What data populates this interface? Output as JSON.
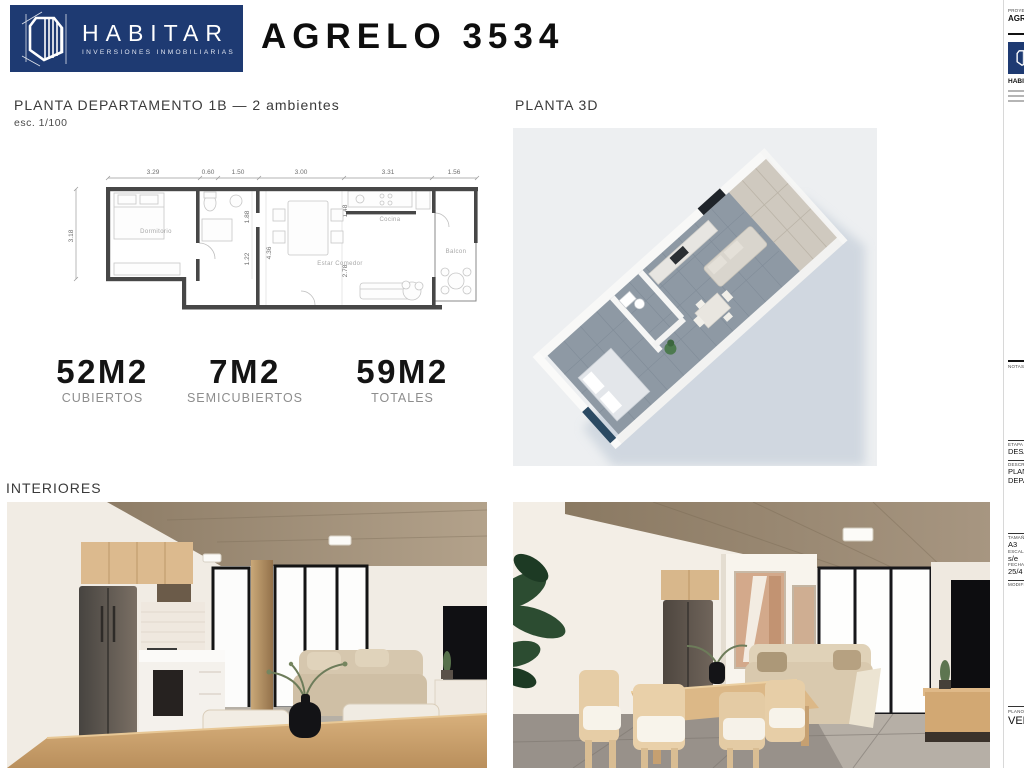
{
  "header": {
    "brand": {
      "name": "HABITAR",
      "subtitle": "INVERSIONES INMOBILIARIAS",
      "bg_color": "#1e3a72"
    },
    "sheet_title": "AGRELO 3534"
  },
  "plan_section": {
    "title": "PLANTA DEPARTAMENTO 1B — 2 ambientes",
    "scale_note": "esc. 1/100",
    "floor_plan": {
      "room_labels": [
        "Dormitorio",
        "Cocina",
        "Estar Comedor",
        "Balcon"
      ],
      "dims_top": [
        "3.29",
        "0.60",
        "1.50",
        "3.00",
        "3.31",
        "1.56"
      ],
      "dim_left": "3.18",
      "dims_inner": [
        "1.88",
        "1.22",
        "4.36",
        "2.78",
        "1.48"
      ]
    }
  },
  "areas": [
    {
      "value": "52M2",
      "label": "CUBIERTOS"
    },
    {
      "value": "7M2",
      "label": "SEMICUBIERTOS"
    },
    {
      "value": "59M2",
      "label": "TOTALES"
    }
  ],
  "planta3d_title": "PLANTA 3D",
  "interiores_title": "INTERIORES",
  "titleblock": {
    "project_label": "PROYECTO",
    "project_value": "AGRELO 3534",
    "brand": "HABITAR",
    "notes_label": "NOTAS",
    "stage_label": "ETAPA",
    "stage_value": "DESARROLLO",
    "description_label": "DESCRIPCIÓN",
    "description_value_line1": "PLANTA",
    "description_value_line2": "DEPARTAMENTO",
    "size_label": "TAMAÑO",
    "size_value": "A3",
    "scale_label": "ESCALA",
    "scale_value": "s/e",
    "date_label": "FECHA",
    "date_value": "25/4",
    "modifications_label": "MODIFICACIONES",
    "sheet_label": "PLANO N",
    "sheet_value": "VENTA"
  },
  "colors": {
    "brand_navy": "#1e3a72",
    "plan_wall": "#474747",
    "render_bg": "#edeff1",
    "shadow_blue": "#c9d2dc"
  }
}
